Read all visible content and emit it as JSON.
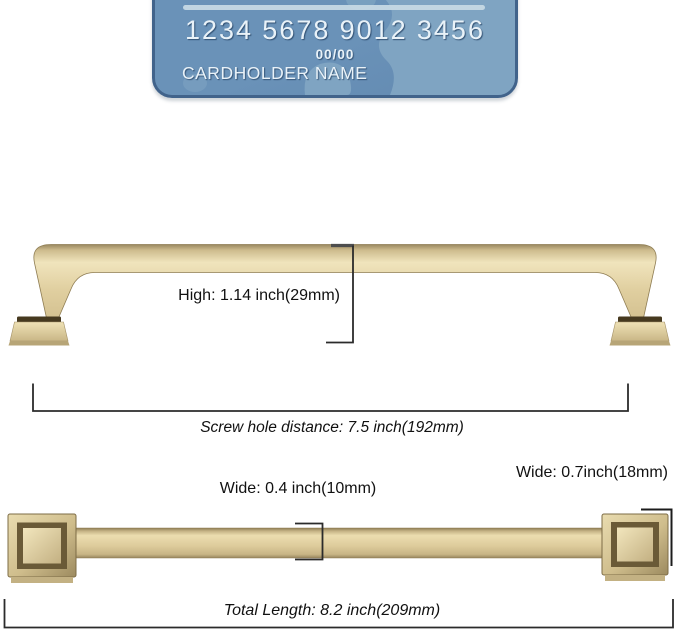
{
  "colors": {
    "card_fill": "#6a92b8",
    "card_fill_low": "#6289b1",
    "card_map": "#7fa4c2",
    "card_border": "#41638b",
    "card_stripe": "#c6d9e4",
    "card_text": "#e9f2f8",
    "gold_light": "#f0e4bc",
    "gold_main": "#ddcc9e",
    "gold_dark": "#a5936a",
    "gold_edge": "#8a784f",
    "foot_shadow": "#46391f",
    "dim_line": "#2b2b2b"
  },
  "card": {
    "number_groups": [
      "1234",
      "5678",
      "9012",
      "3456"
    ],
    "expiry": "00/00",
    "holder": "CARDHOLDER NAME"
  },
  "side_view": {
    "height_label": "High: 1.14 inch(29mm)",
    "screw_distance_label": "Screw hole distance: 7.5  inch(192mm)"
  },
  "top_view": {
    "bar_width_label": "Wide: 0.4 inch(10mm)",
    "cap_width_label": "Wide: 0.7inch(18mm)",
    "total_length_label": "Total Length: 8.2 inch(209mm)"
  }
}
